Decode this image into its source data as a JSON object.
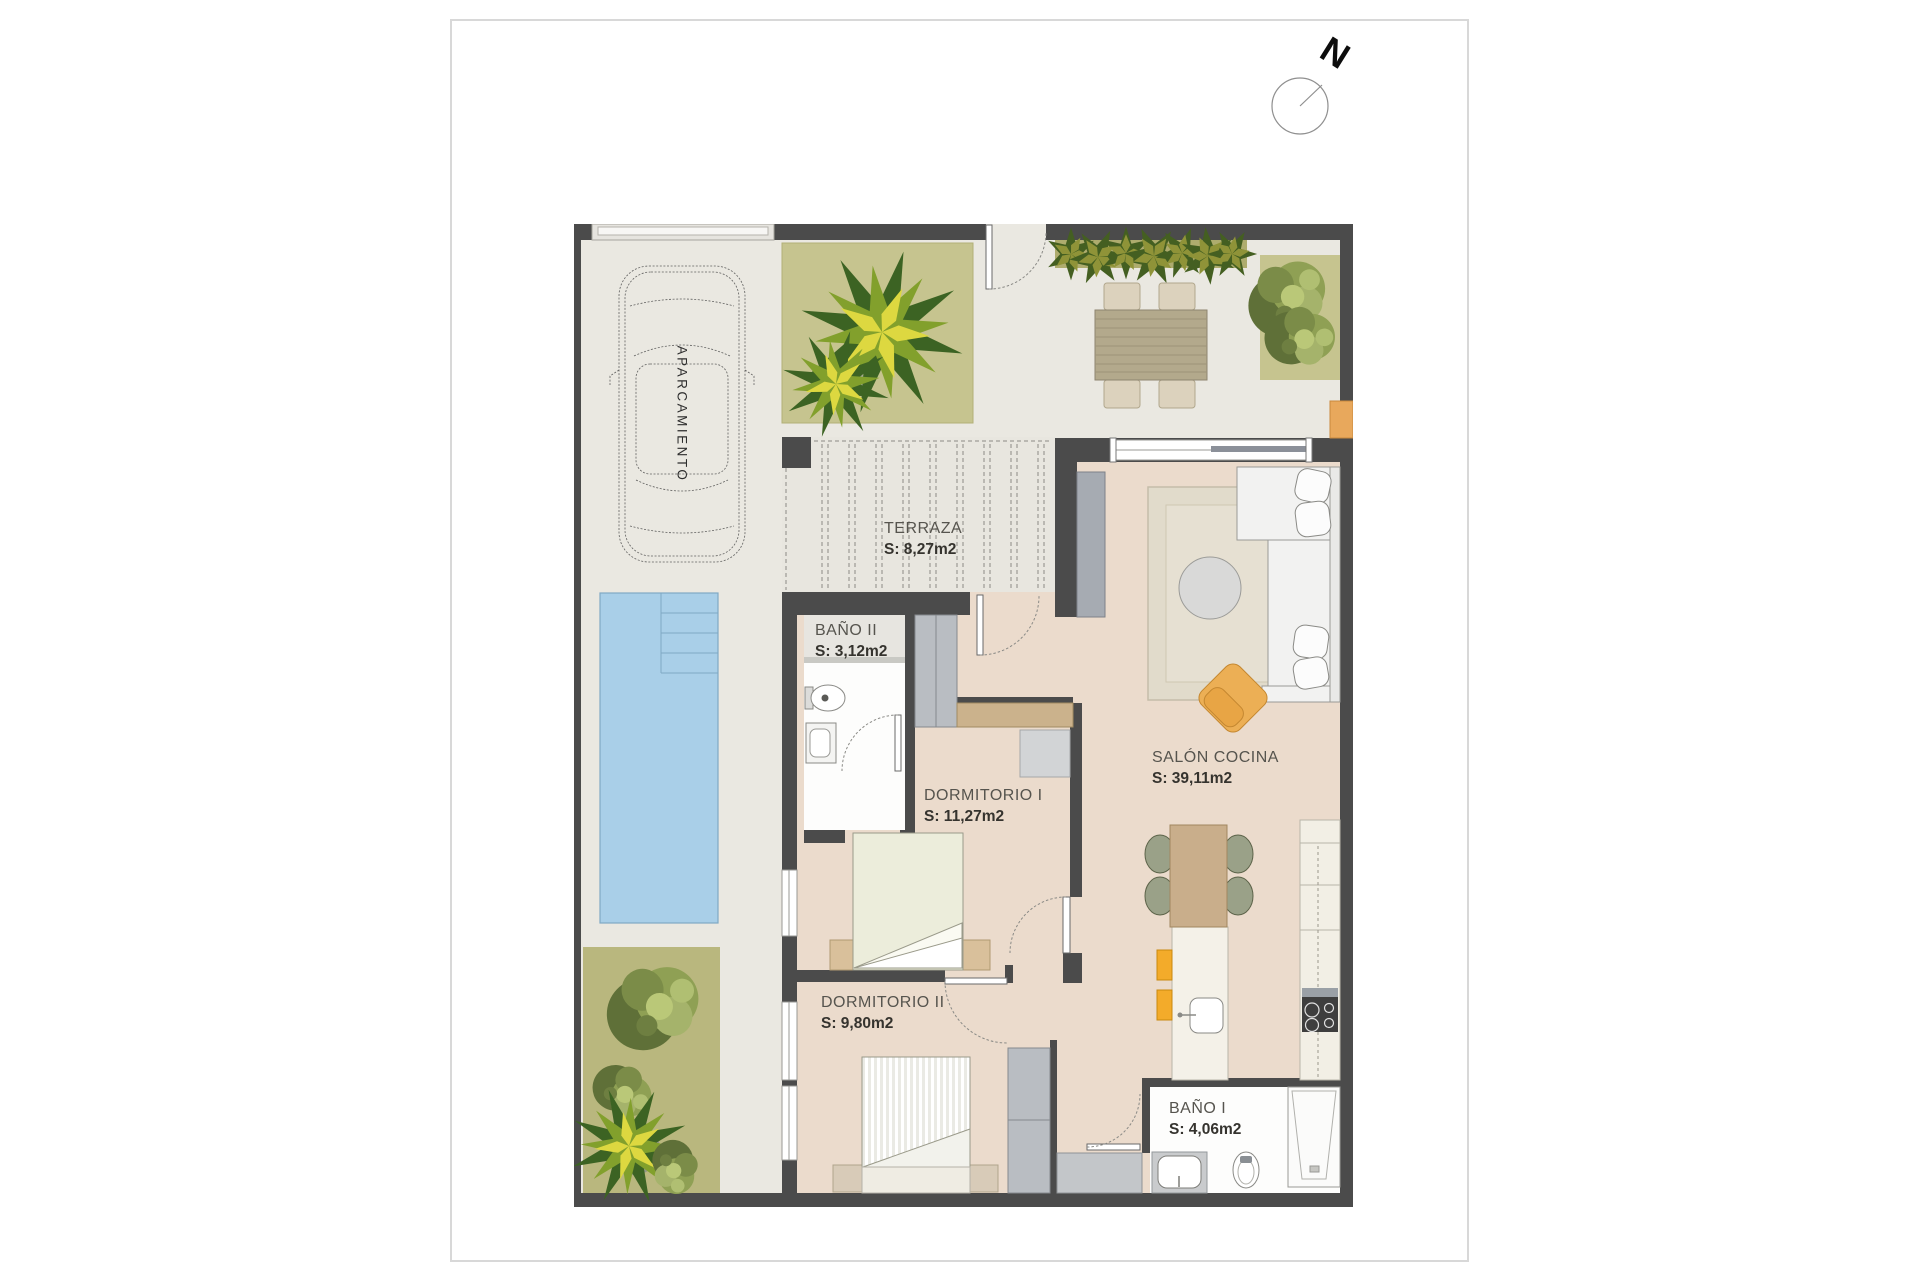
{
  "sheet": {
    "compass_label": "N"
  },
  "plan": {
    "parking_label": "APARCAMIENTO",
    "rooms": [
      {
        "name": "TERRAZA",
        "area": "S: 8,27m2"
      },
      {
        "name": "BAÑO II",
        "area": "S: 3,12m2"
      },
      {
        "name": "DORMITORIO I",
        "area": "S: 11,27m2"
      },
      {
        "name": "SALÓN COCINA",
        "area": "S: 39,11m2"
      },
      {
        "name": "DORMITORIO II",
        "area": "S: 9,80m2"
      },
      {
        "name": "BAÑO I",
        "area": "S: 4,06m2"
      }
    ],
    "palette": {
      "wall": "#4b4b4b",
      "outdoor_floor": "#eae8e1",
      "interior_floor": "#ebdbcc",
      "deck": "#e8e6df",
      "garden": "#c6c48f",
      "hedge_band": "#aeac6e",
      "pool": "#a9cfe8",
      "accent_orange": "#e8a85c",
      "bathroom_floor": "#fdfdfc",
      "furniture_gray": "#b9bdc2",
      "closet_tan": "#cbb28c",
      "stool_yellow": "#f3ab2a"
    }
  }
}
